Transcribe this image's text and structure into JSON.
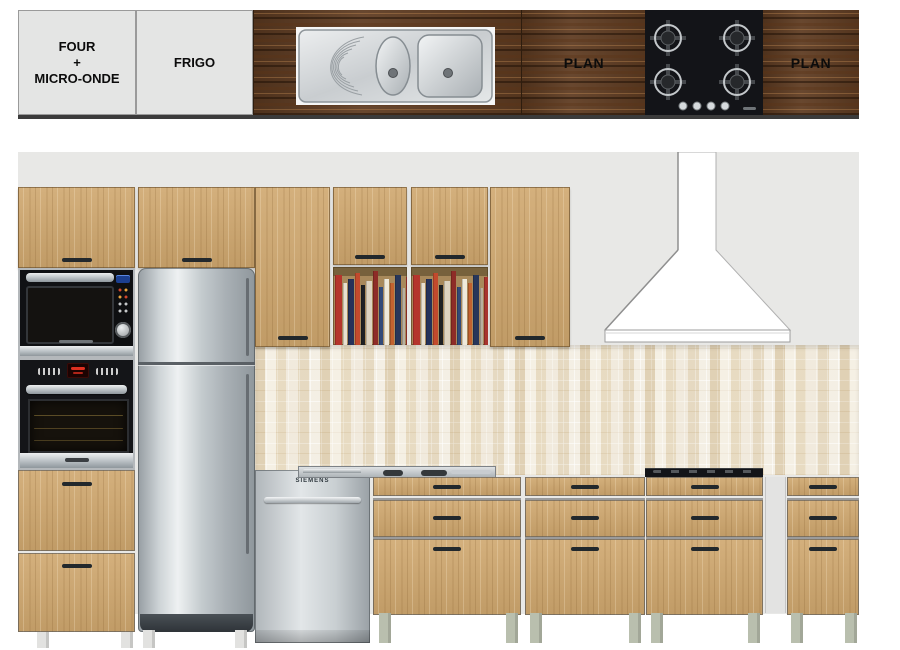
{
  "plan_strip": {
    "cell_four": {
      "line1": "FOUR",
      "line2": "+",
      "line3": "MICRO-ONDE"
    },
    "cell_frigo": {
      "label": "FRIGO"
    },
    "plan_left": {
      "label": "PLAN"
    },
    "plan_right": {
      "label": "PLAN"
    }
  },
  "elevation": {
    "dishwasher": {
      "brand": "SIEMENS"
    },
    "books": [
      {
        "c": "#b5342c",
        "w": 7,
        "h": 70
      },
      {
        "c": "#e8e0cf",
        "w": 4,
        "h": 62
      },
      {
        "c": "#243159",
        "w": 6,
        "h": 66
      },
      {
        "c": "#c24a2d",
        "w": 5,
        "h": 72
      },
      {
        "c": "#1e2023",
        "w": 4,
        "h": 60
      },
      {
        "c": "#ddd3c0",
        "w": 6,
        "h": 64
      },
      {
        "c": "#8e2c27",
        "w": 5,
        "h": 74
      },
      {
        "c": "#324a78",
        "w": 4,
        "h": 58
      },
      {
        "c": "#efe9da",
        "w": 5,
        "h": 66
      },
      {
        "c": "#c2622f",
        "w": 4,
        "h": 62
      },
      {
        "c": "#27365a",
        "w": 6,
        "h": 70
      },
      {
        "c": "#b8b0a0",
        "w": 3,
        "h": 57
      },
      {
        "c": "#a8342e",
        "w": 5,
        "h": 68
      },
      {
        "c": "#1c2a4d",
        "w": 4,
        "h": 63
      },
      {
        "c": "#e3dbc9",
        "w": 5,
        "h": 60
      },
      {
        "c": "#78411f",
        "w": 4,
        "h": 66
      }
    ]
  },
  "palette": {
    "page-bg": "#ffffff",
    "wall": "#e8e8e6",
    "wood-light": "#cfa76e",
    "wood-dark": "#5f3c22",
    "tile-base": "#ece4d3",
    "steel-light": "#e9edee",
    "steel-mid": "#b9c0c4",
    "steel-dark": "#8d959a",
    "handle": "#22282c",
    "hob-black": "#131418",
    "leg-sage": "#b9bfae",
    "leg-white": "#e2e2e0",
    "plan-cell": "#e4e5e4",
    "hood-outline": "#b0b0b0"
  }
}
